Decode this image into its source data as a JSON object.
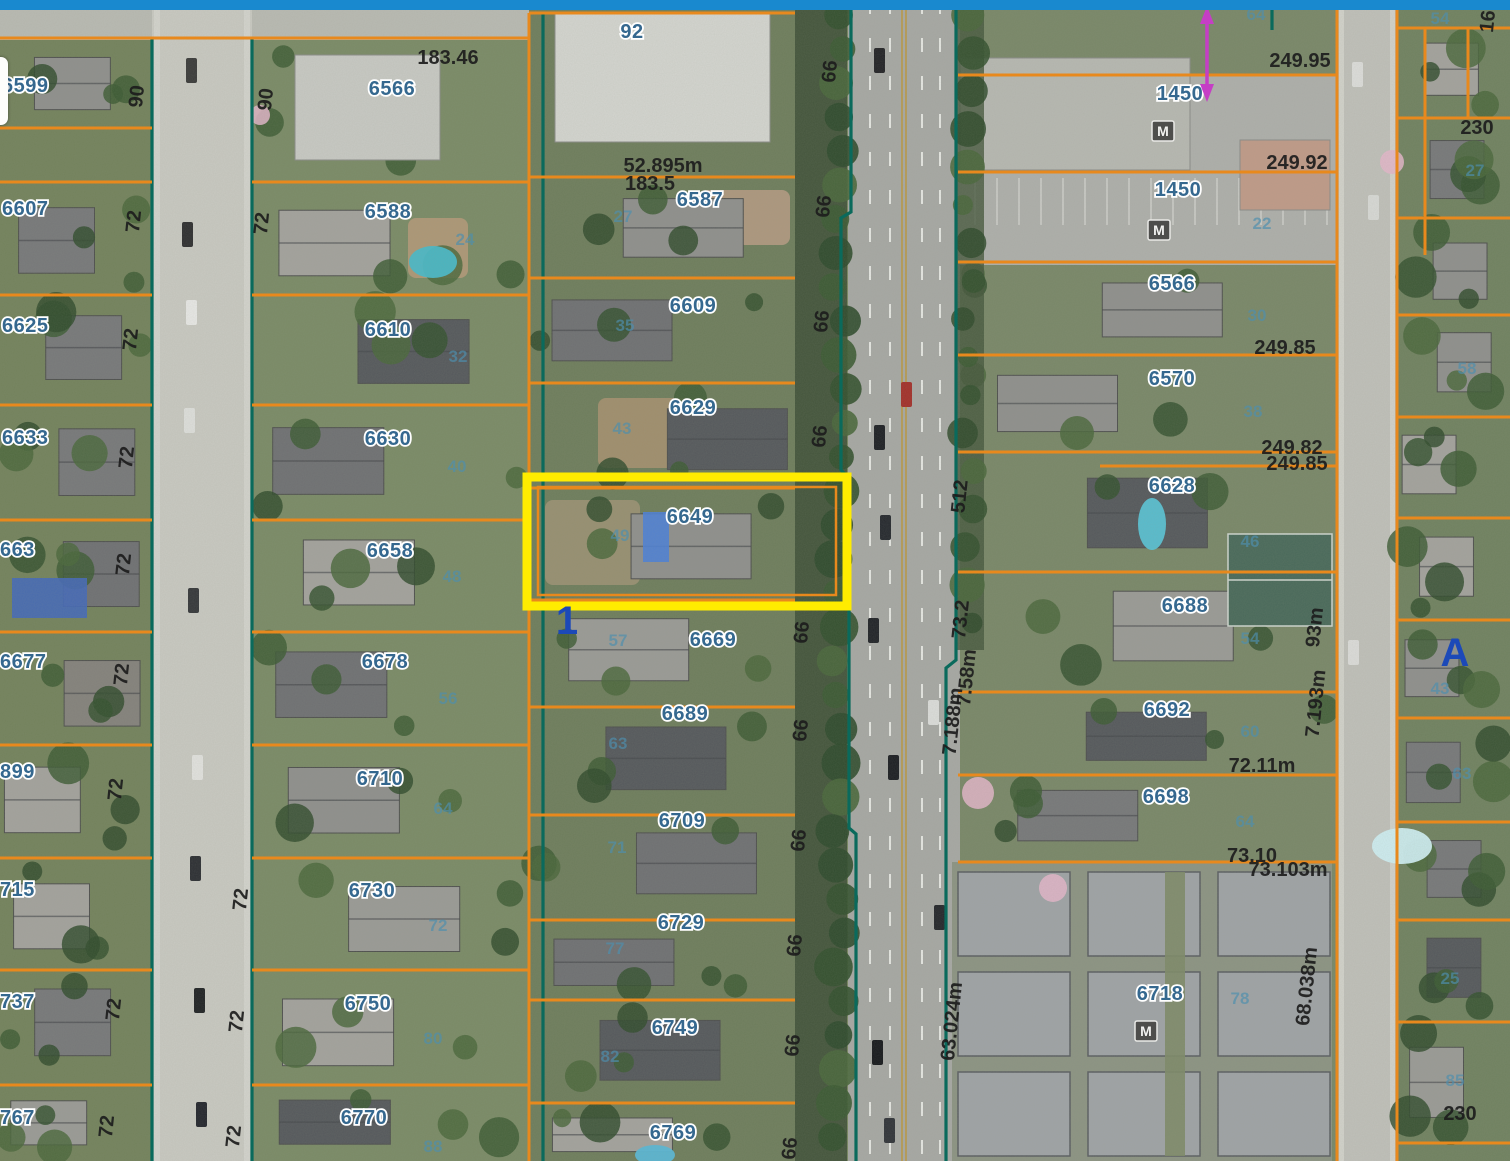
{
  "window": {
    "top_bar_color": "#1989cf"
  },
  "map": {
    "highlight": {
      "parcel_label": "6649",
      "x": 527,
      "y": 477,
      "w": 320,
      "h": 129,
      "color": "#ffec00",
      "inner_parcel_color": "#e8891d"
    },
    "colors": {
      "parcel_line": "#e8891d",
      "road_boundary": "#0a6a5c",
      "address_text": "#35688f",
      "lot_text": "#4e8fae",
      "measure_text": "#1d1d1d",
      "block_letter": "#1c49b8",
      "arrow": "#c53ec5",
      "highlight": "#ffec00"
    },
    "address_labels": [
      {
        "t": "6599",
        "x": 2,
        "y": 92,
        "a": "start"
      },
      {
        "t": "6607",
        "x": 2,
        "y": 215,
        "a": "start"
      },
      {
        "t": "6625",
        "x": 2,
        "y": 332,
        "a": "start"
      },
      {
        "t": "6633",
        "x": 2,
        "y": 444,
        "a": "start"
      },
      {
        "t": "663",
        "x": 0,
        "y": 556,
        "a": "start"
      },
      {
        "t": "6677",
        "x": 0,
        "y": 668,
        "a": "start"
      },
      {
        "t": "899",
        "x": 0,
        "y": 778,
        "a": "start"
      },
      {
        "t": "715",
        "x": 0,
        "y": 896,
        "a": "start"
      },
      {
        "t": "737",
        "x": 0,
        "y": 1008,
        "a": "start"
      },
      {
        "t": "767",
        "x": 0,
        "y": 1124,
        "a": "start"
      },
      {
        "t": "6566",
        "x": 392,
        "y": 95
      },
      {
        "t": "6588",
        "x": 388,
        "y": 218
      },
      {
        "t": "6610",
        "x": 388,
        "y": 336
      },
      {
        "t": "6630",
        "x": 388,
        "y": 445
      },
      {
        "t": "6658",
        "x": 390,
        "y": 557
      },
      {
        "t": "6678",
        "x": 385,
        "y": 668
      },
      {
        "t": "6710",
        "x": 380,
        "y": 785
      },
      {
        "t": "6730",
        "x": 372,
        "y": 897
      },
      {
        "t": "6750",
        "x": 368,
        "y": 1010
      },
      {
        "t": "6770",
        "x": 364,
        "y": 1124
      },
      {
        "t": "92",
        "x": 632,
        "y": 38
      },
      {
        "t": "6587",
        "x": 700,
        "y": 206
      },
      {
        "t": "6609",
        "x": 693,
        "y": 312
      },
      {
        "t": "6629",
        "x": 693,
        "y": 414
      },
      {
        "t": "6649",
        "x": 690,
        "y": 523
      },
      {
        "t": "6669",
        "x": 713,
        "y": 646
      },
      {
        "t": "6689",
        "x": 685,
        "y": 720
      },
      {
        "t": "6709",
        "x": 682,
        "y": 827
      },
      {
        "t": "6729",
        "x": 681,
        "y": 929
      },
      {
        "t": "6749",
        "x": 675,
        "y": 1034
      },
      {
        "t": "6769",
        "x": 673,
        "y": 1139
      },
      {
        "t": "1450",
        "x": 1180,
        "y": 100
      },
      {
        "t": "1450",
        "x": 1178,
        "y": 196
      },
      {
        "t": "6566",
        "x": 1172,
        "y": 290
      },
      {
        "t": "6570",
        "x": 1172,
        "y": 385
      },
      {
        "t": "6628",
        "x": 1172,
        "y": 492
      },
      {
        "t": "6688",
        "x": 1185,
        "y": 612
      },
      {
        "t": "6692",
        "x": 1167,
        "y": 716
      },
      {
        "t": "6698",
        "x": 1166,
        "y": 803
      },
      {
        "t": "6718",
        "x": 1160,
        "y": 1000
      }
    ],
    "lot_number_labels": [
      {
        "t": "24",
        "x": 465,
        "y": 245
      },
      {
        "t": "32",
        "x": 458,
        "y": 362
      },
      {
        "t": "40",
        "x": 457,
        "y": 472
      },
      {
        "t": "48",
        "x": 452,
        "y": 582
      },
      {
        "t": "56",
        "x": 448,
        "y": 704
      },
      {
        "t": "64",
        "x": 443,
        "y": 814
      },
      {
        "t": "72",
        "x": 438,
        "y": 931
      },
      {
        "t": "80",
        "x": 433,
        "y": 1044
      },
      {
        "t": "88",
        "x": 433,
        "y": 1152
      },
      {
        "t": "27",
        "x": 623,
        "y": 222
      },
      {
        "t": "35",
        "x": 625,
        "y": 331
      },
      {
        "t": "43",
        "x": 622,
        "y": 434
      },
      {
        "t": "49",
        "x": 620,
        "y": 541
      },
      {
        "t": "57",
        "x": 618,
        "y": 646
      },
      {
        "t": "63",
        "x": 618,
        "y": 749
      },
      {
        "t": "71",
        "x": 617,
        "y": 853
      },
      {
        "t": "77",
        "x": 615,
        "y": 954
      },
      {
        "t": "82",
        "x": 610,
        "y": 1062
      },
      {
        "t": "22",
        "x": 1262,
        "y": 229
      },
      {
        "t": "30",
        "x": 1257,
        "y": 321
      },
      {
        "t": "38",
        "x": 1253,
        "y": 417
      },
      {
        "t": "46",
        "x": 1250,
        "y": 547
      },
      {
        "t": "54",
        "x": 1250,
        "y": 644
      },
      {
        "t": "60",
        "x": 1250,
        "y": 737
      },
      {
        "t": "64",
        "x": 1245,
        "y": 827
      },
      {
        "t": "78",
        "x": 1240,
        "y": 1004
      },
      {
        "t": "64",
        "x": 1256,
        "y": 20
      },
      {
        "t": "54",
        "x": 1440,
        "y": 24
      },
      {
        "t": "27",
        "x": 1475,
        "y": 176
      },
      {
        "t": "58",
        "x": 1467,
        "y": 374
      },
      {
        "t": "43",
        "x": 1440,
        "y": 694
      },
      {
        "t": "63",
        "x": 1462,
        "y": 779
      },
      {
        "t": "25",
        "x": 1450,
        "y": 984
      },
      {
        "t": "85",
        "x": 1455,
        "y": 1086
      }
    ],
    "measurement_labels": [
      {
        "t": "183.46",
        "x": 448,
        "y": 64
      },
      {
        "t": "52.895m",
        "x": 663,
        "y": 172
      },
      {
        "t": "183.5",
        "x": 650,
        "y": 190
      },
      {
        "t": "249.95",
        "x": 1300,
        "y": 67
      },
      {
        "t": "249.92",
        "x": 1297,
        "y": 169
      },
      {
        "t": "249.85",
        "x": 1285,
        "y": 354
      },
      {
        "t": "249.82",
        "x": 1292,
        "y": 454
      },
      {
        "t": "249.85",
        "x": 1297,
        "y": 470
      },
      {
        "t": "230",
        "x": 1477,
        "y": 134
      },
      {
        "t": "230",
        "x": 1460,
        "y": 1120
      },
      {
        "t": "72.11m",
        "x": 1262,
        "y": 772
      },
      {
        "t": "73.10",
        "x": 1252,
        "y": 862
      },
      {
        "t": "73.103m",
        "x": 1288,
        "y": 876
      }
    ],
    "rotated_measurements": [
      {
        "t": "90",
        "x": 143,
        "y": 97
      },
      {
        "t": "90",
        "x": 272,
        "y": 100
      },
      {
        "t": "72",
        "x": 140,
        "y": 222
      },
      {
        "t": "72",
        "x": 268,
        "y": 224
      },
      {
        "t": "72",
        "x": 137,
        "y": 340
      },
      {
        "t": "72",
        "x": 133,
        "y": 458
      },
      {
        "t": "72",
        "x": 130,
        "y": 565
      },
      {
        "t": "72",
        "x": 128,
        "y": 675
      },
      {
        "t": "72",
        "x": 122,
        "y": 790
      },
      {
        "t": "72",
        "x": 120,
        "y": 1010
      },
      {
        "t": "72",
        "x": 113,
        "y": 1127
      },
      {
        "t": "72",
        "x": 247,
        "y": 900
      },
      {
        "t": "72",
        "x": 243,
        "y": 1022
      },
      {
        "t": "72",
        "x": 240,
        "y": 1137
      },
      {
        "t": "66",
        "x": 836,
        "y": 72
      },
      {
        "t": "66",
        "x": 830,
        "y": 207
      },
      {
        "t": "66",
        "x": 828,
        "y": 322
      },
      {
        "t": "66",
        "x": 826,
        "y": 437
      },
      {
        "t": "66",
        "x": 808,
        "y": 633
      },
      {
        "t": "66",
        "x": 807,
        "y": 731
      },
      {
        "t": "66",
        "x": 805,
        "y": 841
      },
      {
        "t": "66",
        "x": 801,
        "y": 946
      },
      {
        "t": "66",
        "x": 799,
        "y": 1046
      },
      {
        "t": "66",
        "x": 796,
        "y": 1149
      },
      {
        "t": "512",
        "x": 966,
        "y": 497
      },
      {
        "t": "73.2",
        "x": 967,
        "y": 620
      },
      {
        "t": "7.58m",
        "x": 973,
        "y": 678
      },
      {
        "t": "7.188m",
        "x": 959,
        "y": 722
      },
      {
        "t": "63.024m",
        "x": 958,
        "y": 1022
      },
      {
        "t": "93m",
        "x": 1321,
        "y": 628
      },
      {
        "t": "7.193m",
        "x": 1322,
        "y": 704
      },
      {
        "t": "68.038m",
        "x": 1313,
        "y": 987
      },
      {
        "t": "16",
        "x": 1494,
        "y": 22
      }
    ],
    "block_letters": [
      {
        "t": "A",
        "x": 1455,
        "y": 666
      },
      {
        "t": "1",
        "x": 567,
        "y": 634
      }
    ],
    "station_icons": [
      {
        "x": 1163,
        "y": 131
      },
      {
        "x": 1159,
        "y": 230
      },
      {
        "x": 1146,
        "y": 1031
      }
    ],
    "arrow_annotation": {
      "x": 1207,
      "y1": 10,
      "y2": 98
    },
    "geometry": {
      "columns": [
        {
          "x1": 0,
          "x2": 152,
          "hx1": 4,
          "hx2": 142,
          "lawn": "#73825c",
          "ys": [
            38,
            128,
            182,
            295,
            405,
            520,
            632,
            745,
            858,
            970,
            1085,
            1161
          ]
        },
        {
          "x1": 252,
          "x2": 529,
          "hx1": 268,
          "hx2": 470,
          "lawn": "#7a8a66",
          "ys": [
            38,
            182,
            295,
            405,
            520,
            632,
            745,
            858,
            970,
            1085,
            1161
          ]
        },
        {
          "x1": 529,
          "x2": 795,
          "hx1": 552,
          "hx2": 788,
          "lawn": "#6e7d5c",
          "ys": [
            13,
            177,
            278,
            383,
            488,
            600,
            707,
            815,
            920,
            1000,
            1103,
            1161
          ]
        },
        {
          "x1": 958,
          "x2": 1337,
          "hx1": 985,
          "hx2": 1240,
          "lawn": "#798768",
          "ys": [
            262,
            355,
            452,
            572,
            692,
            775,
            862
          ],
          "skip_house": []
        },
        {
          "x1": 1397,
          "x2": 1510,
          "hx1": 1402,
          "hx2": 1500,
          "lawn": "#708160",
          "ys": [
            28,
            118,
            218,
            315,
            417,
            518,
            620,
            718,
            822,
            920,
            1022,
            1143,
            1161
          ]
        }
      ],
      "orange_h_extra": [
        {
          "x1": 152,
          "x2": 252,
          "y": 38
        },
        {
          "x1": 958,
          "x2": 1337,
          "y": 75
        },
        {
          "x1": 958,
          "x2": 1337,
          "y": 172
        },
        {
          "x1": 529,
          "x2": 770,
          "y": 13
        },
        {
          "x1": 1100,
          "x2": 1337,
          "y": 466
        }
      ],
      "orange_v": [
        {
          "x": 529,
          "y1": 13,
          "y2": 1161
        },
        {
          "x": 1337,
          "y1": 0,
          "y2": 1161
        },
        {
          "x": 1397,
          "y1": 0,
          "y2": 1161
        },
        {
          "x": 1425,
          "y1": 28,
          "y2": 255
        },
        {
          "x": 1468,
          "y1": 28,
          "y2": 118
        }
      ],
      "teal_paths": [
        "M152 38 V1161",
        "M252 38 V1161",
        "M543 13 V1161",
        "M851 0 V212 L841 218 V470 L849 478 V828 L856 834 V1161",
        "M956 0 V660 L946 668 V1161",
        "M1272 0 V30"
      ],
      "streets": [
        {
          "x": 0,
          "y": 10,
          "w": 529,
          "h": 30,
          "c": "#b9bab3"
        },
        {
          "x": 152,
          "y": 10,
          "w": 100,
          "h": 1151,
          "c": "#c9c9c2"
        },
        {
          "x": 848,
          "y": 0,
          "w": 112,
          "h": 1161,
          "c": "#a7a8a4"
        },
        {
          "x": 1337,
          "y": 0,
          "w": 60,
          "h": 1161,
          "c": "#c0c0ba"
        },
        {
          "x": 958,
          "y": 75,
          "w": 379,
          "h": 190,
          "c": "#aeafab"
        }
      ]
    }
  }
}
